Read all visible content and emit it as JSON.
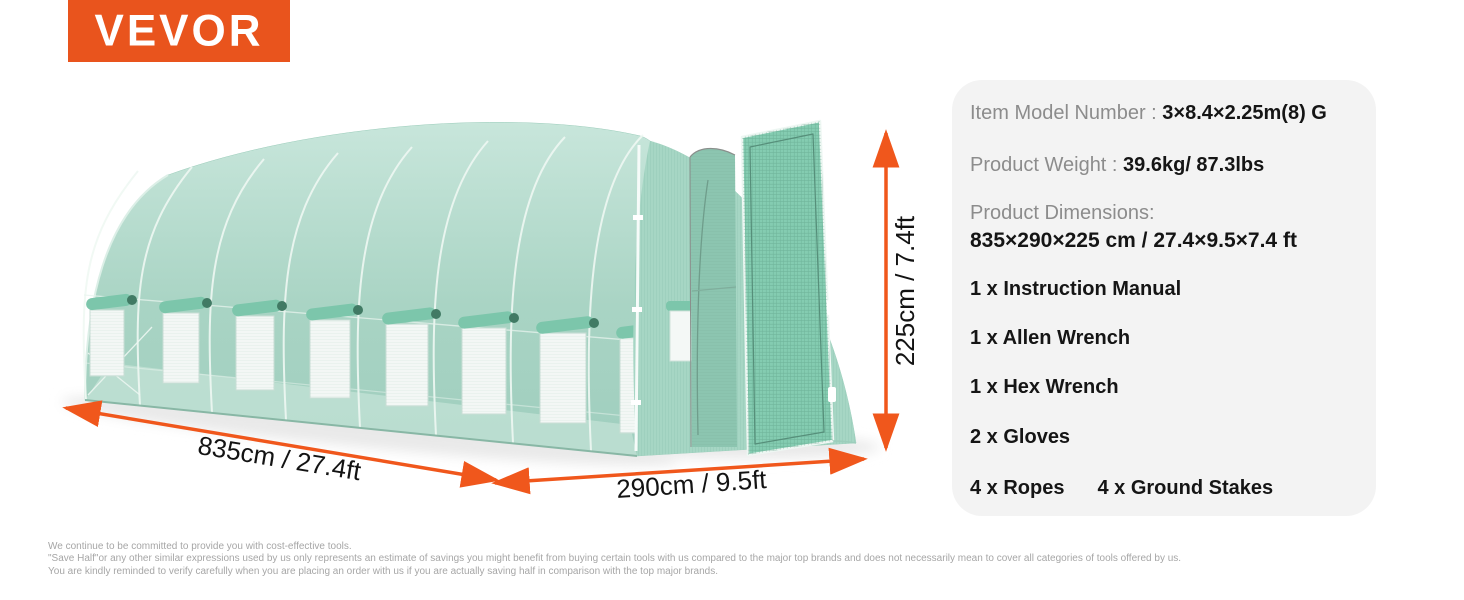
{
  "brand": {
    "name": "VEVOR"
  },
  "colors": {
    "brand_orange": "#E9541D",
    "arrow_orange": "#F0571C",
    "panel_bg": "#F3F3F3",
    "greenhouse_green": "#A9D4C4"
  },
  "panel": {
    "model_label": "Item Model Number : ",
    "model_value": "3×8.4×2.25m(8) G",
    "weight_label": "Product Weight : ",
    "weight_value": "39.6kg/ 87.3lbs",
    "dimensions_label": "Product Dimensions:",
    "dimensions_value": "835×290×225 cm / 27.4×9.5×7.4 ft",
    "items": [
      "1 x Instruction Manual",
      "1 x Allen Wrench",
      "1 x Hex Wrench",
      "2 x Gloves",
      "4 x Ropes",
      "4 x Ground Stakes"
    ]
  },
  "diagram": {
    "length_label": "835cm / 27.4ft",
    "width_label": "290cm / 9.5ft",
    "height_label": "225cm / 7.4ft"
  },
  "footer": {
    "lines": [
      "We continue to be committed to provide you with cost-effective tools.",
      "\"Save Half\"or any other similar expressions used by us only represents an estimate of savings you might benefit from buying certain tools with us compared to the major top brands and does not necessarily mean to cover all categories of tools offered by us.",
      "You are kindly reminded to verify carefully when you are placing an order with us if you are actually saving half in comparison with the top major brands."
    ]
  }
}
